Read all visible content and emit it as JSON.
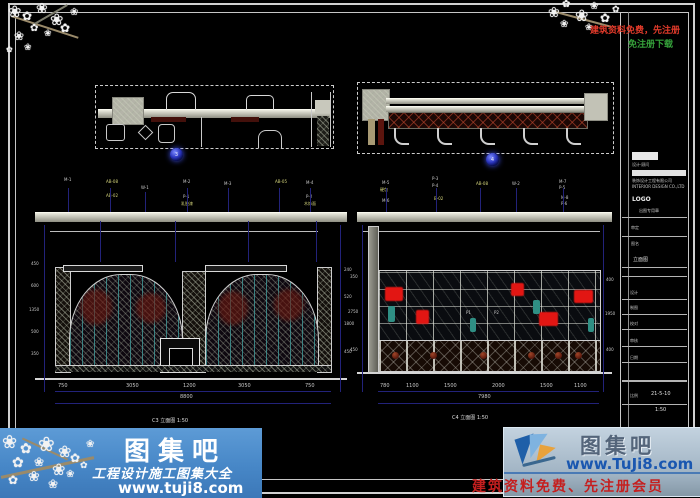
{
  "icons": {
    "flower": "❀",
    "flower2": "✿"
  },
  "markers": {
    "left": "3",
    "right": "4"
  },
  "elev_left": {
    "materials": [
      "M-1",
      "AB-08",
      "AB-02",
      "W-1",
      "M-2",
      "P-1",
      "乳胶漆",
      "M-3",
      "AB-05",
      "M-4",
      "P-2",
      "木饰面"
    ],
    "dims": [
      "750",
      "3050",
      "1200",
      "3050",
      "750"
    ],
    "total": "8800",
    "vdims": [
      "450",
      "600",
      "1350",
      "500",
      "350"
    ],
    "vdims_r": [
      "240",
      "520",
      "1800",
      "450"
    ],
    "label": "C3 立面图 1:50"
  },
  "elev_right": {
    "materials": [
      "M-5",
      "硬包",
      "M-6",
      "P-3",
      "P-4",
      "B-02",
      "AB-08",
      "W-2",
      "M-7",
      "P-5",
      "M-8",
      "P-6"
    ],
    "dims": [
      "780",
      "1100",
      "1500",
      "2000",
      "1500",
      "1100"
    ],
    "total": "7980",
    "vdims": [
      "350",
      "2750",
      "450"
    ],
    "vdims_r": [
      "400",
      "1950",
      "400"
    ],
    "cells": [
      "P1",
      "P2"
    ],
    "label": "C4 立面图 1:50"
  },
  "title_block": {
    "brand_caption": "设计·顾问",
    "company_line1": "装饰设计工程有限公司",
    "company_line2": "INTERIOR DESIGN CO.,LTD",
    "logo": "LOGO",
    "stamp_note": "出图专用章",
    "approve_label": "审定",
    "drawing_label": "图名",
    "drawing_name": "立面图",
    "rows": [
      "设计",
      "制图",
      "校对",
      "审核"
    ],
    "date_label": "日期",
    "date": "21-5-10",
    "scale_label": "比例",
    "scale": "1:50"
  },
  "watermark": {
    "top_right_line1": "建筑资料免费，先注册",
    "top_right_line2": "免注册下载",
    "bottom_left": {
      "title": "图集吧",
      "subtitle": "工程设计施工图集大全",
      "url": "www.tuji8.com"
    },
    "bottom_right": {
      "title": "图集吧",
      "url": "www.TuJi8.com",
      "note": "建筑资料免费、先注册会员"
    }
  }
}
